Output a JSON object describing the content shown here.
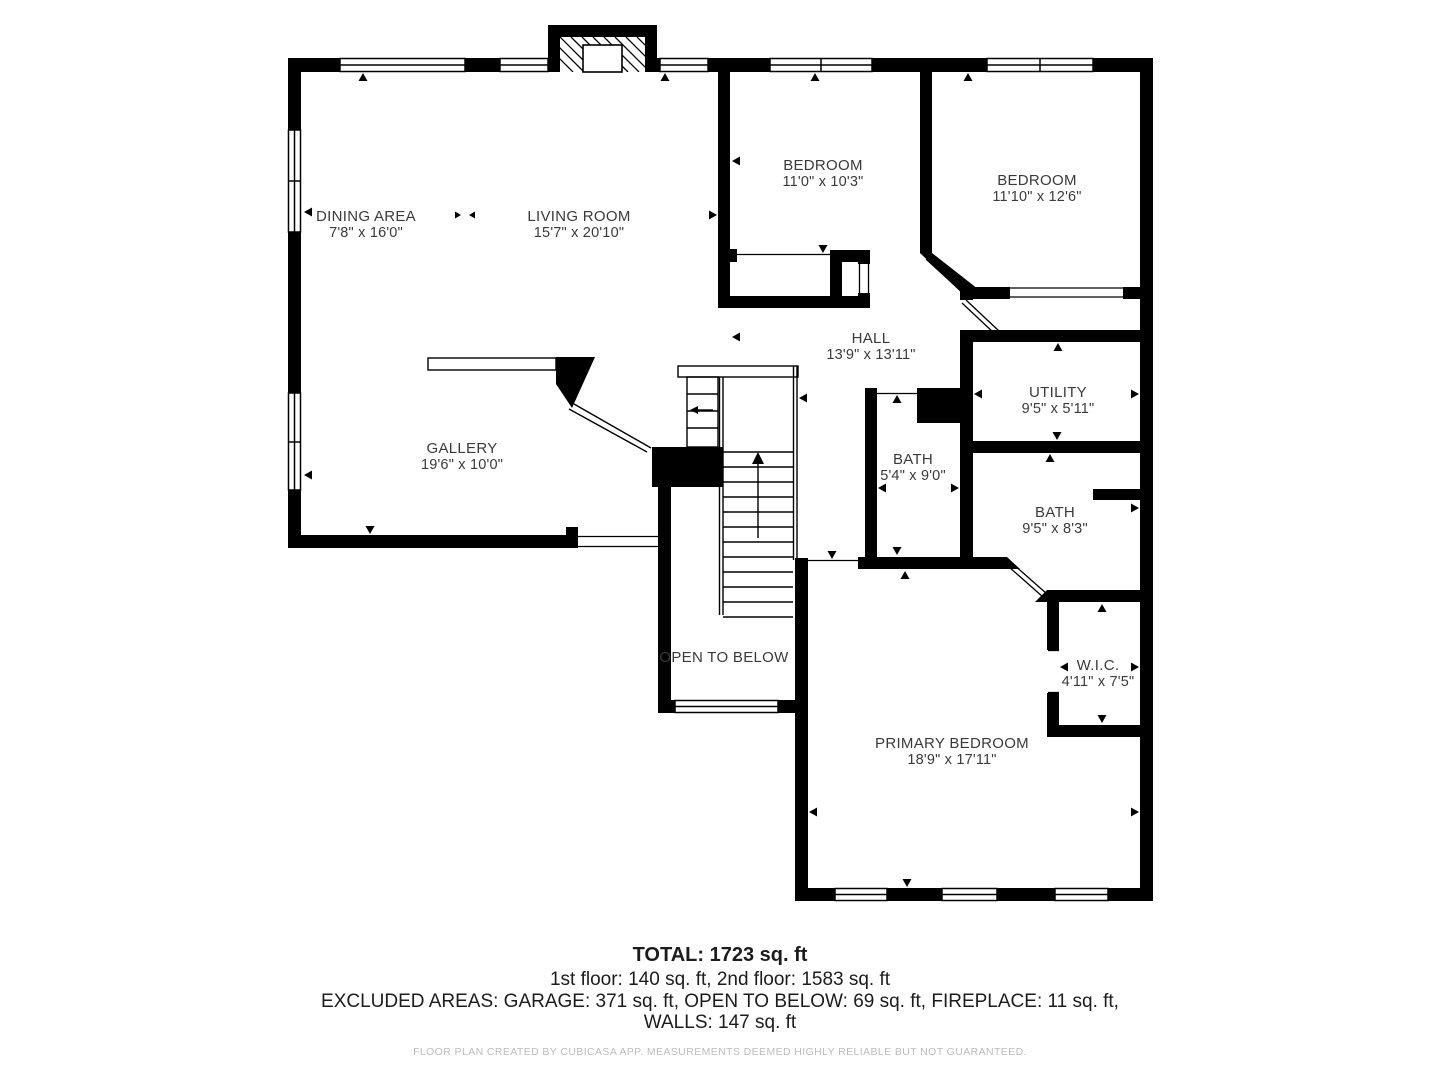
{
  "floor_plan": {
    "rooms": [
      {
        "name": "DINING AREA",
        "dims": "7'8\" x 16'0\""
      },
      {
        "name": "LIVING ROOM",
        "dims": "15'7\" x 20'10\""
      },
      {
        "name": "BEDROOM",
        "dims": "11'0\" x 10'3\""
      },
      {
        "name": "BEDROOM",
        "dims": "11'10\" x 12'6\""
      },
      {
        "name": "HALL",
        "dims": "13'9\" x 13'11\""
      },
      {
        "name": "UTILITY",
        "dims": "9'5\" x 5'11\""
      },
      {
        "name": "BATH",
        "dims": "5'4\" x 9'0\""
      },
      {
        "name": "BATH",
        "dims": "9'5\" x 8'3\""
      },
      {
        "name": "GALLERY",
        "dims": "19'6\" x 10'0\""
      },
      {
        "name": "OPEN TO BELOW",
        "dims": ""
      },
      {
        "name": "W.I.C.",
        "dims": "4'11\" x 7'5\""
      },
      {
        "name": "PRIMARY BEDROOM",
        "dims": "18'9\" x 17'11\""
      }
    ],
    "summary": {
      "total": "TOTAL: 1723 sq. ft",
      "floors": "1st floor: 140 sq. ft, 2nd floor: 1583 sq. ft",
      "excluded": "EXCLUDED AREAS: GARAGE: 371 sq. ft, OPEN TO BELOW: 69 sq. ft, FIREPLACE: 11 sq. ft,",
      "walls": "WALLS: 147 sq. ft"
    },
    "footer": "FLOOR PLAN CREATED BY CUBICASA APP. MEASUREMENTS DEEMED HIGHLY RELIABLE BUT NOT GUARANTEED.",
    "colors": {
      "wall": "#000000",
      "background": "#ffffff",
      "label_text": "#3a3a3a",
      "footer_text": "#bcbcbc"
    }
  }
}
